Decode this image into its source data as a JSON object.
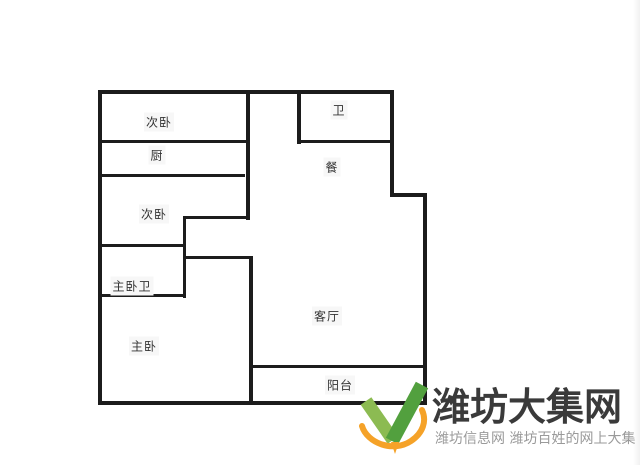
{
  "page": {
    "background": "#ffffff",
    "wall_color": "#1c1c1c",
    "label_color": "#333333"
  },
  "floorplan": {
    "rooms": [
      {
        "id": "secondary-bedroom-top",
        "label": "次卧"
      },
      {
        "id": "kitchen",
        "label": "厨"
      },
      {
        "id": "secondary-bedroom-mid",
        "label": "次卧"
      },
      {
        "id": "master-bathroom",
        "label": "主卧卫"
      },
      {
        "id": "master-bedroom",
        "label": "主卧"
      },
      {
        "id": "bathroom",
        "label": "卫"
      },
      {
        "id": "dining",
        "label": "餐"
      },
      {
        "id": "living-room",
        "label": "客厅"
      },
      {
        "id": "balcony",
        "label": "阳台"
      }
    ]
  },
  "logo": {
    "site_name": "潍坊大集网",
    "tagline": "潍坊信息网 潍坊百姓的网上大集",
    "colors": {
      "green_light": "#8cbb52",
      "green_dark": "#52a03e",
      "orange": "#f5a228",
      "title": "#3a3a3a",
      "tagline": "#9a9a9a"
    }
  }
}
